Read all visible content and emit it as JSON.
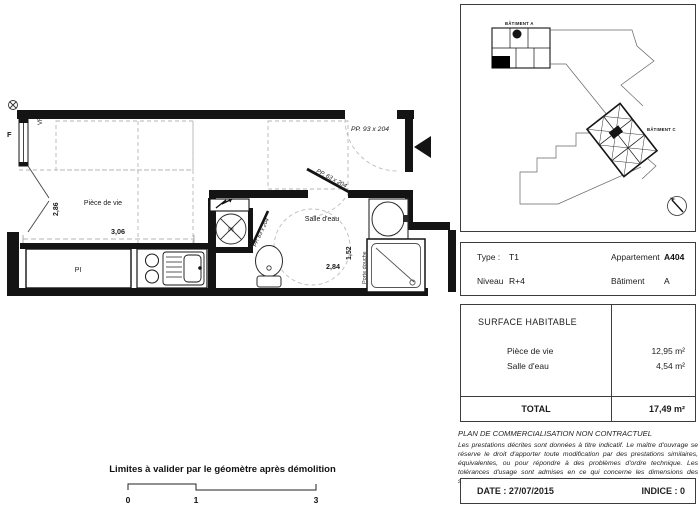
{
  "floor_plan": {
    "labels": {
      "f": "F",
      "vr": "VR",
      "piece_de_vie": "Pièce de vie",
      "salle_deau": "Salle d'eau",
      "pi_closet": "PI",
      "pi_tank": "PI",
      "porte_douche": "Porte douche"
    },
    "dimensions": {
      "d286": "2,86",
      "d306": "3,06",
      "d152": "1,52",
      "d284": "2,84"
    },
    "doors": {
      "pp93": "PP. 93 x 204",
      "pp63_bath": "PP. 63 x 204",
      "pp63_closet": "PP. 63 x 204"
    }
  },
  "site_plan": {
    "batiment_a": "BÂTIMENT A",
    "batiment_c": "BÂTIMENT C"
  },
  "info": {
    "type_label": "Type :",
    "type_value": "T1",
    "appartement_label": "Appartement",
    "appartement_value": "A404",
    "niveau_label": "Niveau",
    "niveau_value": "R+4",
    "batiment_label": "Bâtiment",
    "batiment_value": "A"
  },
  "surface": {
    "header": "SURFACE HABITABLE",
    "rows": [
      {
        "label": "Pièce de vie",
        "value": "12,95 m²"
      },
      {
        "label": "Salle d'eau",
        "value": "4,54 m²"
      }
    ],
    "total_label": "TOTAL",
    "total_value": "17,49 m²"
  },
  "legal": {
    "title": "PLAN DE COMMERCIALISATION NON CONTRACTUEL",
    "body": "Les prestations décrites sont données à titre indicatif. Le maître d'ouvrage se réserve le droit d'apporter toute modification par des prestations similaires, équivalentes, ou pour répondre à des problèmes d'ordre technique. Les tolérances d'usage sont admises en ce qui concerne les dimensions des surfaces indiquées."
  },
  "footer": {
    "date": "DATE : 27/07/2015",
    "indice": "INDICE : 0"
  },
  "scale_bar": {
    "note": "Limites à valider par le géomètre après démolition",
    "ticks": [
      "0",
      "1",
      "3"
    ]
  },
  "colors": {
    "line": "#141414",
    "dashed": "#b5b5b5",
    "accent": "#000000"
  }
}
